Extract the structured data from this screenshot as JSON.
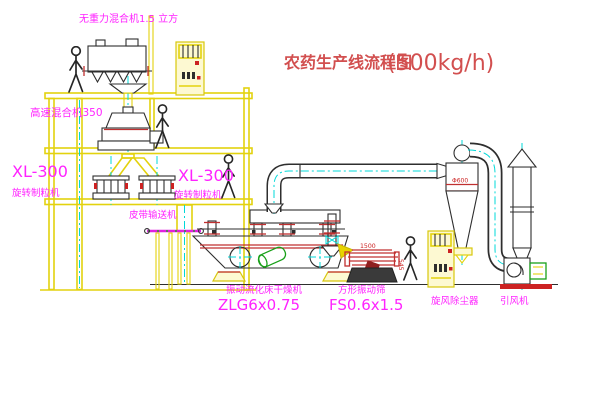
{
  "page": {
    "background": "#ffffff",
    "kind": "pesticide production line CAD flow drawing"
  },
  "title": {
    "text": "农药生产线流程图",
    "capacity": "(500kg/h)",
    "color": "#d24f4f"
  },
  "labels": {
    "gravity_mixer": "无重力混合机1.5 立方",
    "high_speed_mixer": "高速混合机350",
    "granulator_left_model": "XL-300",
    "granulator_left_name": "旋转制粒机",
    "granulator_right_model": "XL-300",
    "granulator_right_name": "旋转制粒机",
    "belt_conveyor": "皮带输送机",
    "dryer_name": "振动流化床干燥机",
    "dryer_model": "ZLG6x0.75",
    "sieve_name": "方形振动筛",
    "sieve_model": "FS0.6x1.5",
    "cyclone": "旋风除尘器",
    "fan": "引风机"
  },
  "dimensions": {
    "sieve_length": "1500",
    "sieve_height": "545",
    "cyclone_diameter": "Φ600"
  },
  "colors": {
    "structure_yellow": "#e3d20e",
    "centerline_cyan": "#00d8d8",
    "label_magenta": "#ff22ff",
    "dimension_red": "#cc2222",
    "machine_green": "#18a018"
  }
}
